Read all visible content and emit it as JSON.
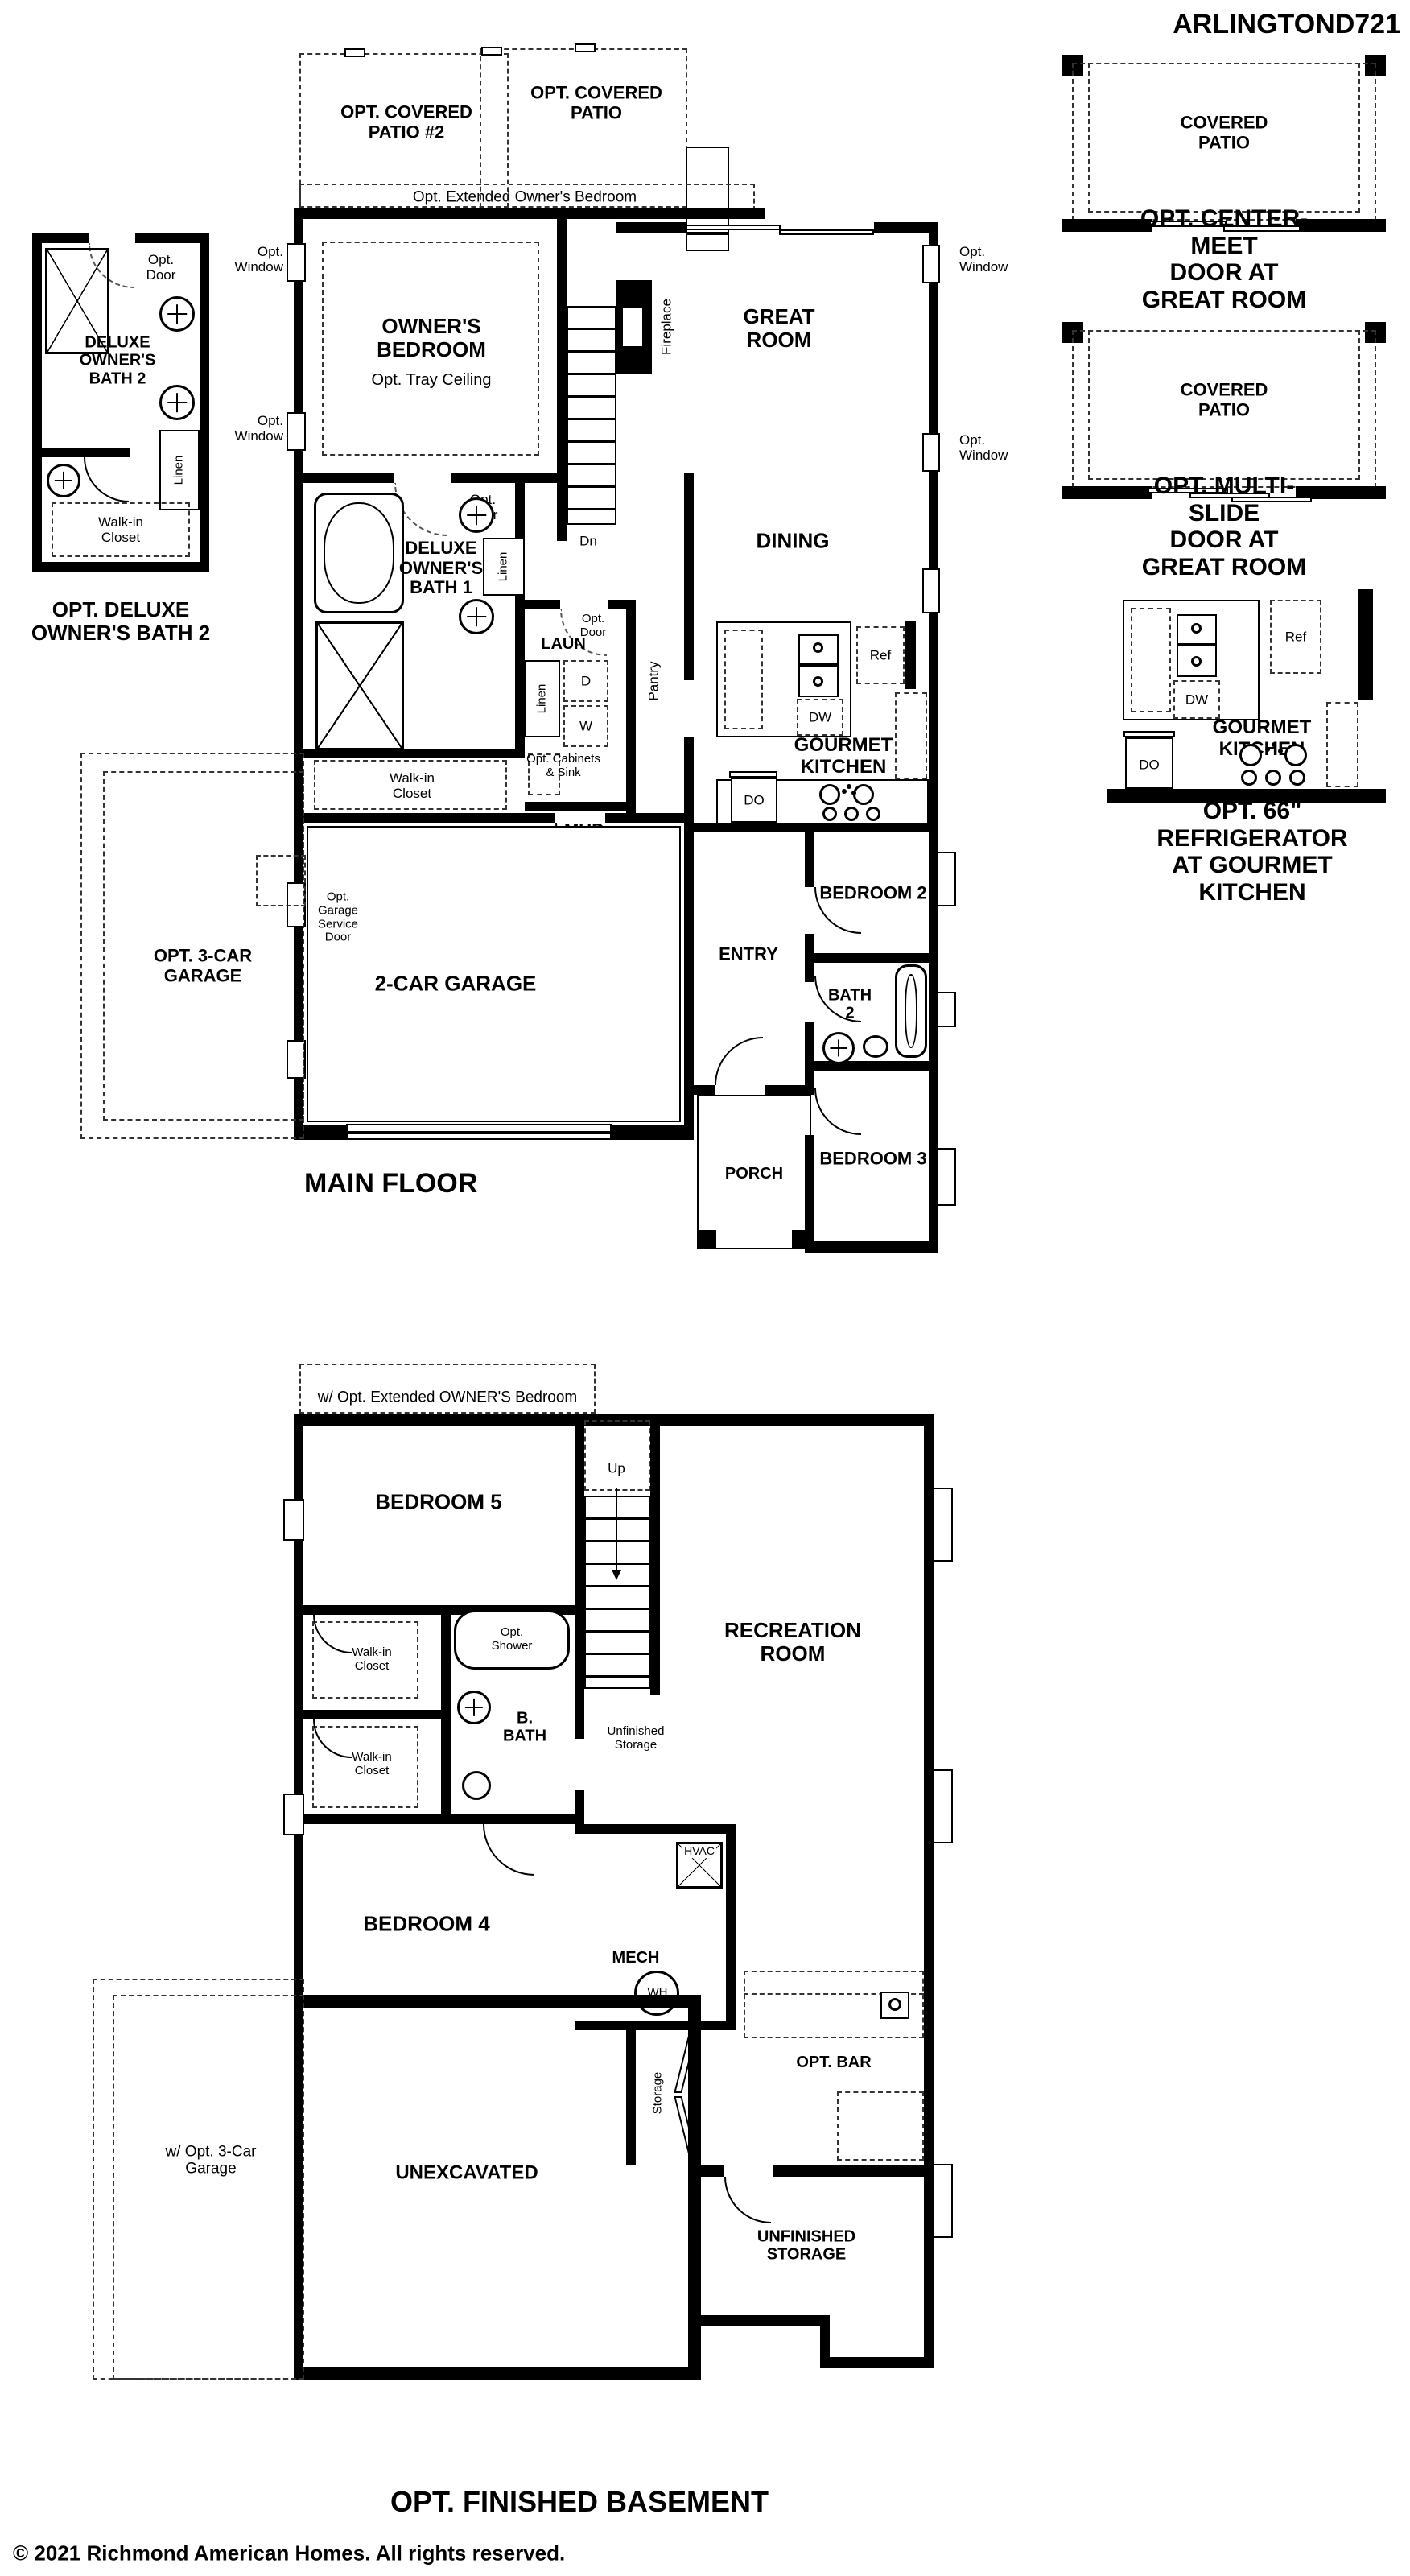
{
  "plan_title": "ARLINGTOND721",
  "shared": {
    "covered_patio": "COVERED\nPATIO",
    "opt_window": "Opt.\nWindow",
    "opt_door": "Opt.\nDoor",
    "linen": "Linen",
    "walk_in_closet": "Walk-in\nCloset",
    "ref": "Ref",
    "dw": "DW",
    "do": "DO",
    "gourmet_kitchen": "GOURMET\nKITCHEN"
  },
  "options": {
    "center_meet": {
      "caption": "OPT. CENTER-MEET\nDOOR AT GREAT ROOM"
    },
    "multi_slide": {
      "caption": "OPT. MULTI-SLIDE\nDOOR AT GREAT ROOM"
    },
    "refrigerator": {
      "caption": "OPT. 66\" REFRIGERATOR\nAT GOURMET KITCHEN"
    }
  },
  "inset_bath": {
    "room": "DELUXE\nOWNER'S\nBATH 2",
    "title": "OPT. DELUXE\nOWNER'S BATH 2"
  },
  "main_floor": {
    "title": "MAIN FLOOR",
    "opt_covered_patio_2": "OPT. COVERED\nPATIO #2",
    "opt_covered_patio": "OPT. COVERED\nPATIO",
    "opt_extended_bedroom": "Opt. Extended Owner's Bedroom",
    "owners_bedroom": "OWNER'S\nBEDROOM",
    "opt_tray_ceiling": "Opt. Tray Ceiling",
    "great_room": "GREAT\nROOM",
    "fireplace": "Fireplace",
    "dn": "Dn",
    "dining": "DINING",
    "deluxe_bath_1": "DELUXE\nOWNER'S\nBATH 1",
    "laun": "LAUN",
    "d": "D",
    "w": "W",
    "opt_cabinets_sink": "Opt. Cabinets\n& Sink",
    "pantry": "Pantry",
    "mud": "MUD",
    "bedroom_2": "BEDROOM 2",
    "bath_2": "BATH\n2",
    "bedroom_3": "BEDROOM 3",
    "entry": "ENTRY",
    "porch": "PORCH",
    "garage": "2-CAR GARAGE",
    "opt_garage_service_door": "Opt.\nGarage\nService\nDoor",
    "opt_3_car_garage": "OPT. 3-CAR\nGARAGE"
  },
  "basement": {
    "title": "OPT. FINISHED BASEMENT",
    "extended_note": "w/ Opt. Extended OWNER'S Bedroom",
    "bedroom_5": "BEDROOM 5",
    "up": "Up",
    "recreation_room": "RECREATION\nROOM",
    "opt_shower": "Opt.\nShower",
    "b_bath": "B.\nBATH",
    "unfinished_storage_small": "Unfinished\nStorage",
    "bedroom_4": "BEDROOM 4",
    "mech": "MECH",
    "hvac": "HVAC",
    "wh": "WH",
    "storage": "Storage",
    "opt_bar": "OPT. BAR",
    "unexcavated": "UNEXCAVATED",
    "unfinished_storage": "UNFINISHED\nSTORAGE",
    "opt_3_car_note": "w/ Opt. 3-Car\nGarage"
  },
  "footer": {
    "copyright": "© 2021 Richmond American Homes. All rights reserved."
  }
}
